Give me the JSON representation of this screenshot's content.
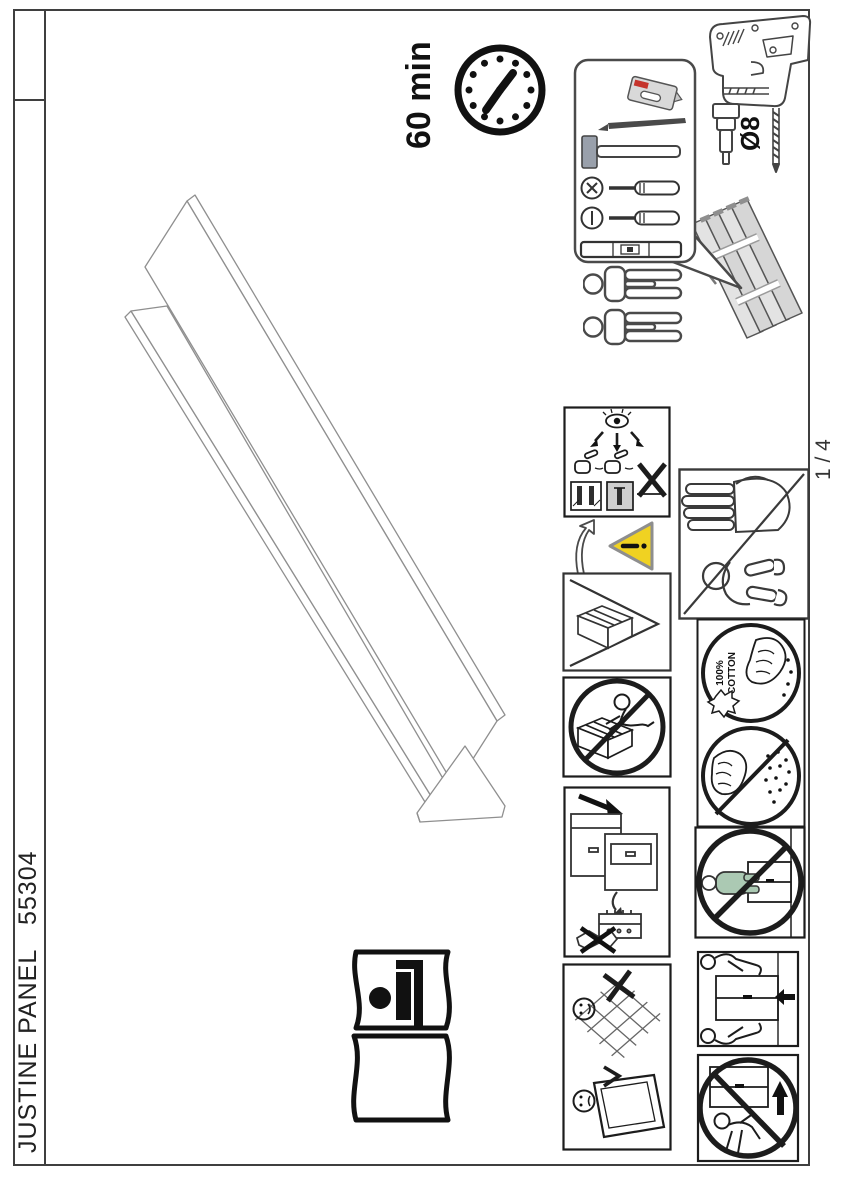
{
  "document": {
    "product_title": "JUSTINE PANEL",
    "product_code": "55304",
    "page_number": "1 / 4"
  },
  "assembly": {
    "time": "60 min",
    "people_required": 2,
    "drill_bit": "Ø8"
  },
  "care": {
    "cotton_line1": "100%",
    "cotton_line2": "COTTON"
  },
  "colors": {
    "line_dark": "#1c1c1c",
    "line_gray": "#555555",
    "warning_yellow": "#f0d222",
    "knife_red": "#c5342c",
    "person_green": "#abc9b3",
    "panel_gray": "#dedede"
  },
  "icons": [
    "clock-icon",
    "tools-bubble",
    "utility-knife-icon",
    "pencil-icon",
    "hammer-icon",
    "phillips-screwdriver-icon",
    "flat-screwdriver-icon",
    "level-icon",
    "drill-icon",
    "drill-bit-icon",
    "two-people-icon",
    "panel-stack",
    "wall-check-pictogram",
    "flip-arrow-icon",
    "warning-triangle-icon",
    "parts-box-pictogram",
    "no-standing-pictogram",
    "keep-fittings-pictogram",
    "soft-surface-pictogram",
    "adults-only-pictogram",
    "cotton-cleaning-pictogram",
    "no-wet-cleaning-pictogram",
    "no-pushing-pictogram",
    "carry-with-two-pictogram",
    "no-dragging-pictogram",
    "wall-mount-bed-icon",
    "panel-isometric-drawing"
  ]
}
